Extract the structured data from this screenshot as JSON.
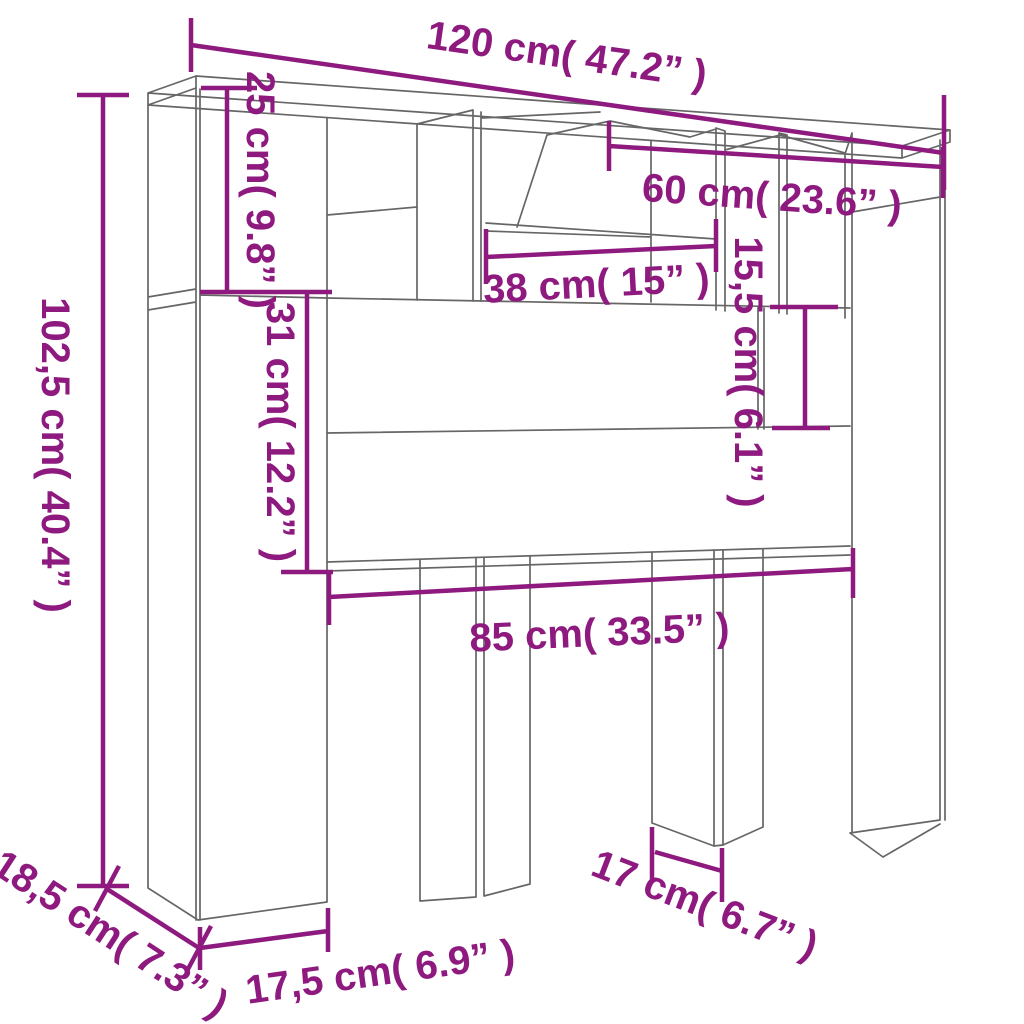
{
  "meta": {
    "type": "product-dimension-diagram",
    "subject": "headboard cabinet with storage compartments",
    "view": "isometric line drawing",
    "units": [
      "cm",
      "inches"
    ]
  },
  "colors": {
    "dimension_color": "#8e1a7f",
    "drawing_color": "#666666",
    "background": "#ffffff"
  },
  "dimensions": {
    "total_width": {
      "label": "120 cm( 47.2” )",
      "cm": "120",
      "inches": "47.2"
    },
    "top_compartment_height": {
      "label": "25 cm( 9.8” )",
      "cm": "25",
      "inches": "9.8"
    },
    "middle_panel_height": {
      "label": "31 cm( 12.2” )",
      "cm": "31",
      "inches": "12.2"
    },
    "shelf_width": {
      "label": "38 cm( 15” )",
      "cm": "38",
      "inches": "15"
    },
    "right_section_width": {
      "label": "60 cm( 23.6” )",
      "cm": "60",
      "inches": "23.6"
    },
    "right_compartment_height": {
      "label": "15,5 cm( 6.1” )",
      "cm": "15,5",
      "inches": "6.1"
    },
    "total_height": {
      "label": "102,5 cm( 40.4” )",
      "cm": "102,5",
      "inches": "40.4"
    },
    "lower_opening_width": {
      "label": "85 cm( 33.5” )",
      "cm": "85",
      "inches": "33.5"
    },
    "depth": {
      "label": "18,5 cm( 7.3” )",
      "cm": "18,5",
      "inches": "7.3"
    },
    "left_column_width": {
      "label": "17,5 cm( 6.9” )",
      "cm": "17,5",
      "inches": "6.9"
    },
    "leg_width": {
      "label": "17 cm( 6.7” )",
      "cm": "17",
      "inches": "6.7"
    }
  }
}
